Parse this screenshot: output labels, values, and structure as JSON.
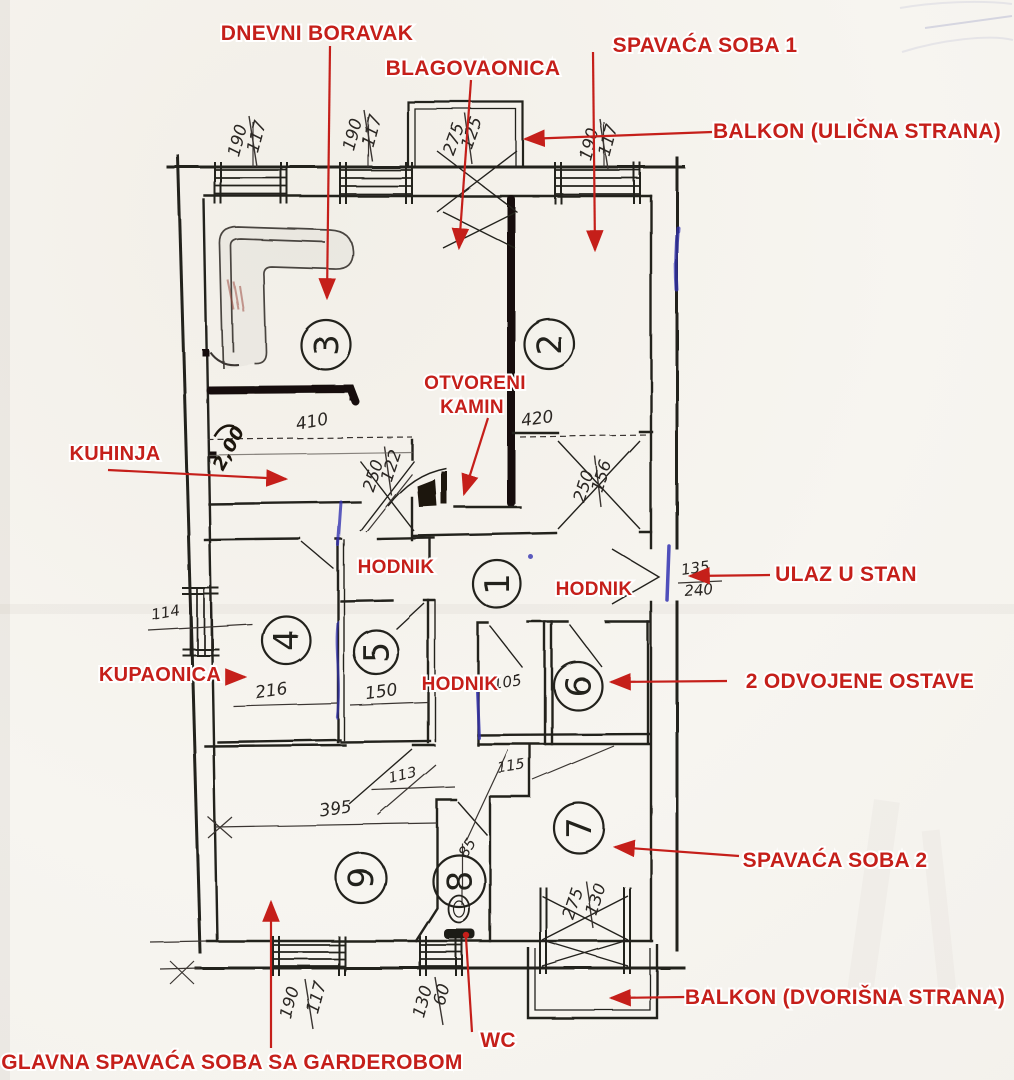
{
  "colors": {
    "annotation_red": "#c51f1a",
    "ink": "#23201d",
    "marker_black": "#17110c",
    "blue_pen": "#3333b2",
    "paper": "#f6f4ef"
  },
  "labels": {
    "dnevni_boravak": "DNEVNI BORAVAK",
    "blagovaonica": "BLAGOVAONICA",
    "spavaca_soba_1": "SPAVAĆA SOBA 1",
    "balkon_ulicna": "BALKON (ULIČNA STRANA)",
    "otvoreni_kamin_line1": "OTVORENI",
    "otvoreni_kamin_line2": "KAMIN",
    "kuhinja": "KUHINJA",
    "hodnik_a": "HODNIK",
    "hodnik_b": "HODNIK",
    "hodnik_c": "HODNIK",
    "ulaz_u_stan": "ULAZ U STAN",
    "kupaonica": "KUPAONICA",
    "ostave": "2 ODVOJENE OSTAVE",
    "spavaca_soba_2": "SPAVAĆA SOBA 2",
    "balkon_dvorisna": "BALKON (DVORIŠNA STRANA)",
    "wc": "WC",
    "glavna_spavaca": "GLAVNA SPAVAĆA SOBA SA GARDEROBOM"
  },
  "room_numbers": {
    "r1": "1",
    "r2": "2",
    "r3": "3",
    "r4": "4",
    "r5": "5",
    "r6": "6",
    "r7": "7",
    "r8": "8",
    "r9": "9"
  },
  "dimensions": {
    "top_win1_h": "190",
    "top_win1_w": "117",
    "top_win2_h": "190",
    "top_win2_w": "117",
    "balcony_door_h": "275",
    "balcony_door_w": "125",
    "top_win3_h": "190",
    "top_win3_w": "117",
    "living_width": "410",
    "bedroom1_width": "420",
    "kitchen_door_w": "122",
    "kitchen_door_h": "250",
    "bedroom1_door_w": "156",
    "bedroom1_door_h": "250",
    "entry_w": "135",
    "entry_h": "240",
    "bath_window": "114",
    "bath_width": "216",
    "hall5_width": "150",
    "storage_width": "105",
    "storage_depth": "115",
    "corridor_a": "113",
    "room9_width": "395",
    "wc_width": "85",
    "terrace_door_h": "275",
    "terrace_door_w": "130",
    "bot_win_h": "190",
    "bot_win_w": "117",
    "wc_win_h": "130",
    "wc_win_w": "60",
    "handwritten_note": "2,00"
  }
}
